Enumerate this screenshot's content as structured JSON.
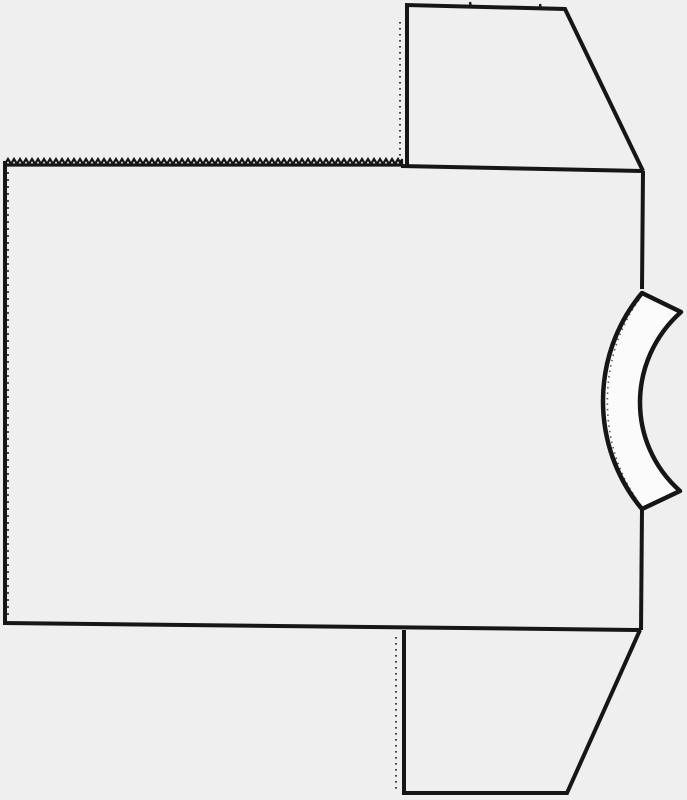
{
  "meta": {
    "description": "Scanned black-and-white sewing pattern line drawing: T-shaped garment piece with rectangular body panel, pinked zigzag top edge, two trapezoidal sleeve extensions on the right side, dotted fold lines, and a curved neckband strip notched into the right edge",
    "canvas": {
      "width": 687,
      "height": 800
    }
  },
  "colors": {
    "paper": "#efefef",
    "ink": "#161616",
    "band_fill": "#fbfbfb"
  },
  "shapes": {
    "body_panel": {
      "label": "body panel",
      "left_edge": "M 5 161 L 5 623",
      "left_serration": "M 8 172 L 8 616",
      "bottom_edge": "M 3 623 L 641 630",
      "right_edge_upper": "M 643 171 L 642 289",
      "right_edge_lower": "M 642 509 L 641 630",
      "top_edge_right": "M 401 166 L 643 171",
      "top_edge_base": "M 5 165 L 402 165",
      "zigzag": {
        "x1": 5,
        "x2": 402,
        "y": 164,
        "tooth_width": 6,
        "tooth_height": 5
      }
    },
    "top_sleeve": {
      "label": "top sleeve piece",
      "outline": "M 407 168 L 407 5 L 565 9 L 643 171",
      "fold_line": "M 400 22 L 400 161",
      "notch_1": "M 470 2 L 471 8",
      "notch_2": "M 540 4 L 541 10"
    },
    "bottom_sleeve": {
      "label": "bottom sleeve piece",
      "outline": "M 404 630 L 404 793 L 567 793 L 640 630",
      "fold_line": "M 396 637 L 396 789"
    },
    "neckband": {
      "label": "curved neckband strip",
      "outline": "M 642 293 L 681 312 C 627 360 626 443 680 491 L 642 509 C 590 447 590 355 642 293 Z",
      "texture_outer": "M 639 300 C 597 357 597 445 638 501",
      "texture_inner": "M 675 316 C 630 362 629 441 674 487"
    }
  }
}
